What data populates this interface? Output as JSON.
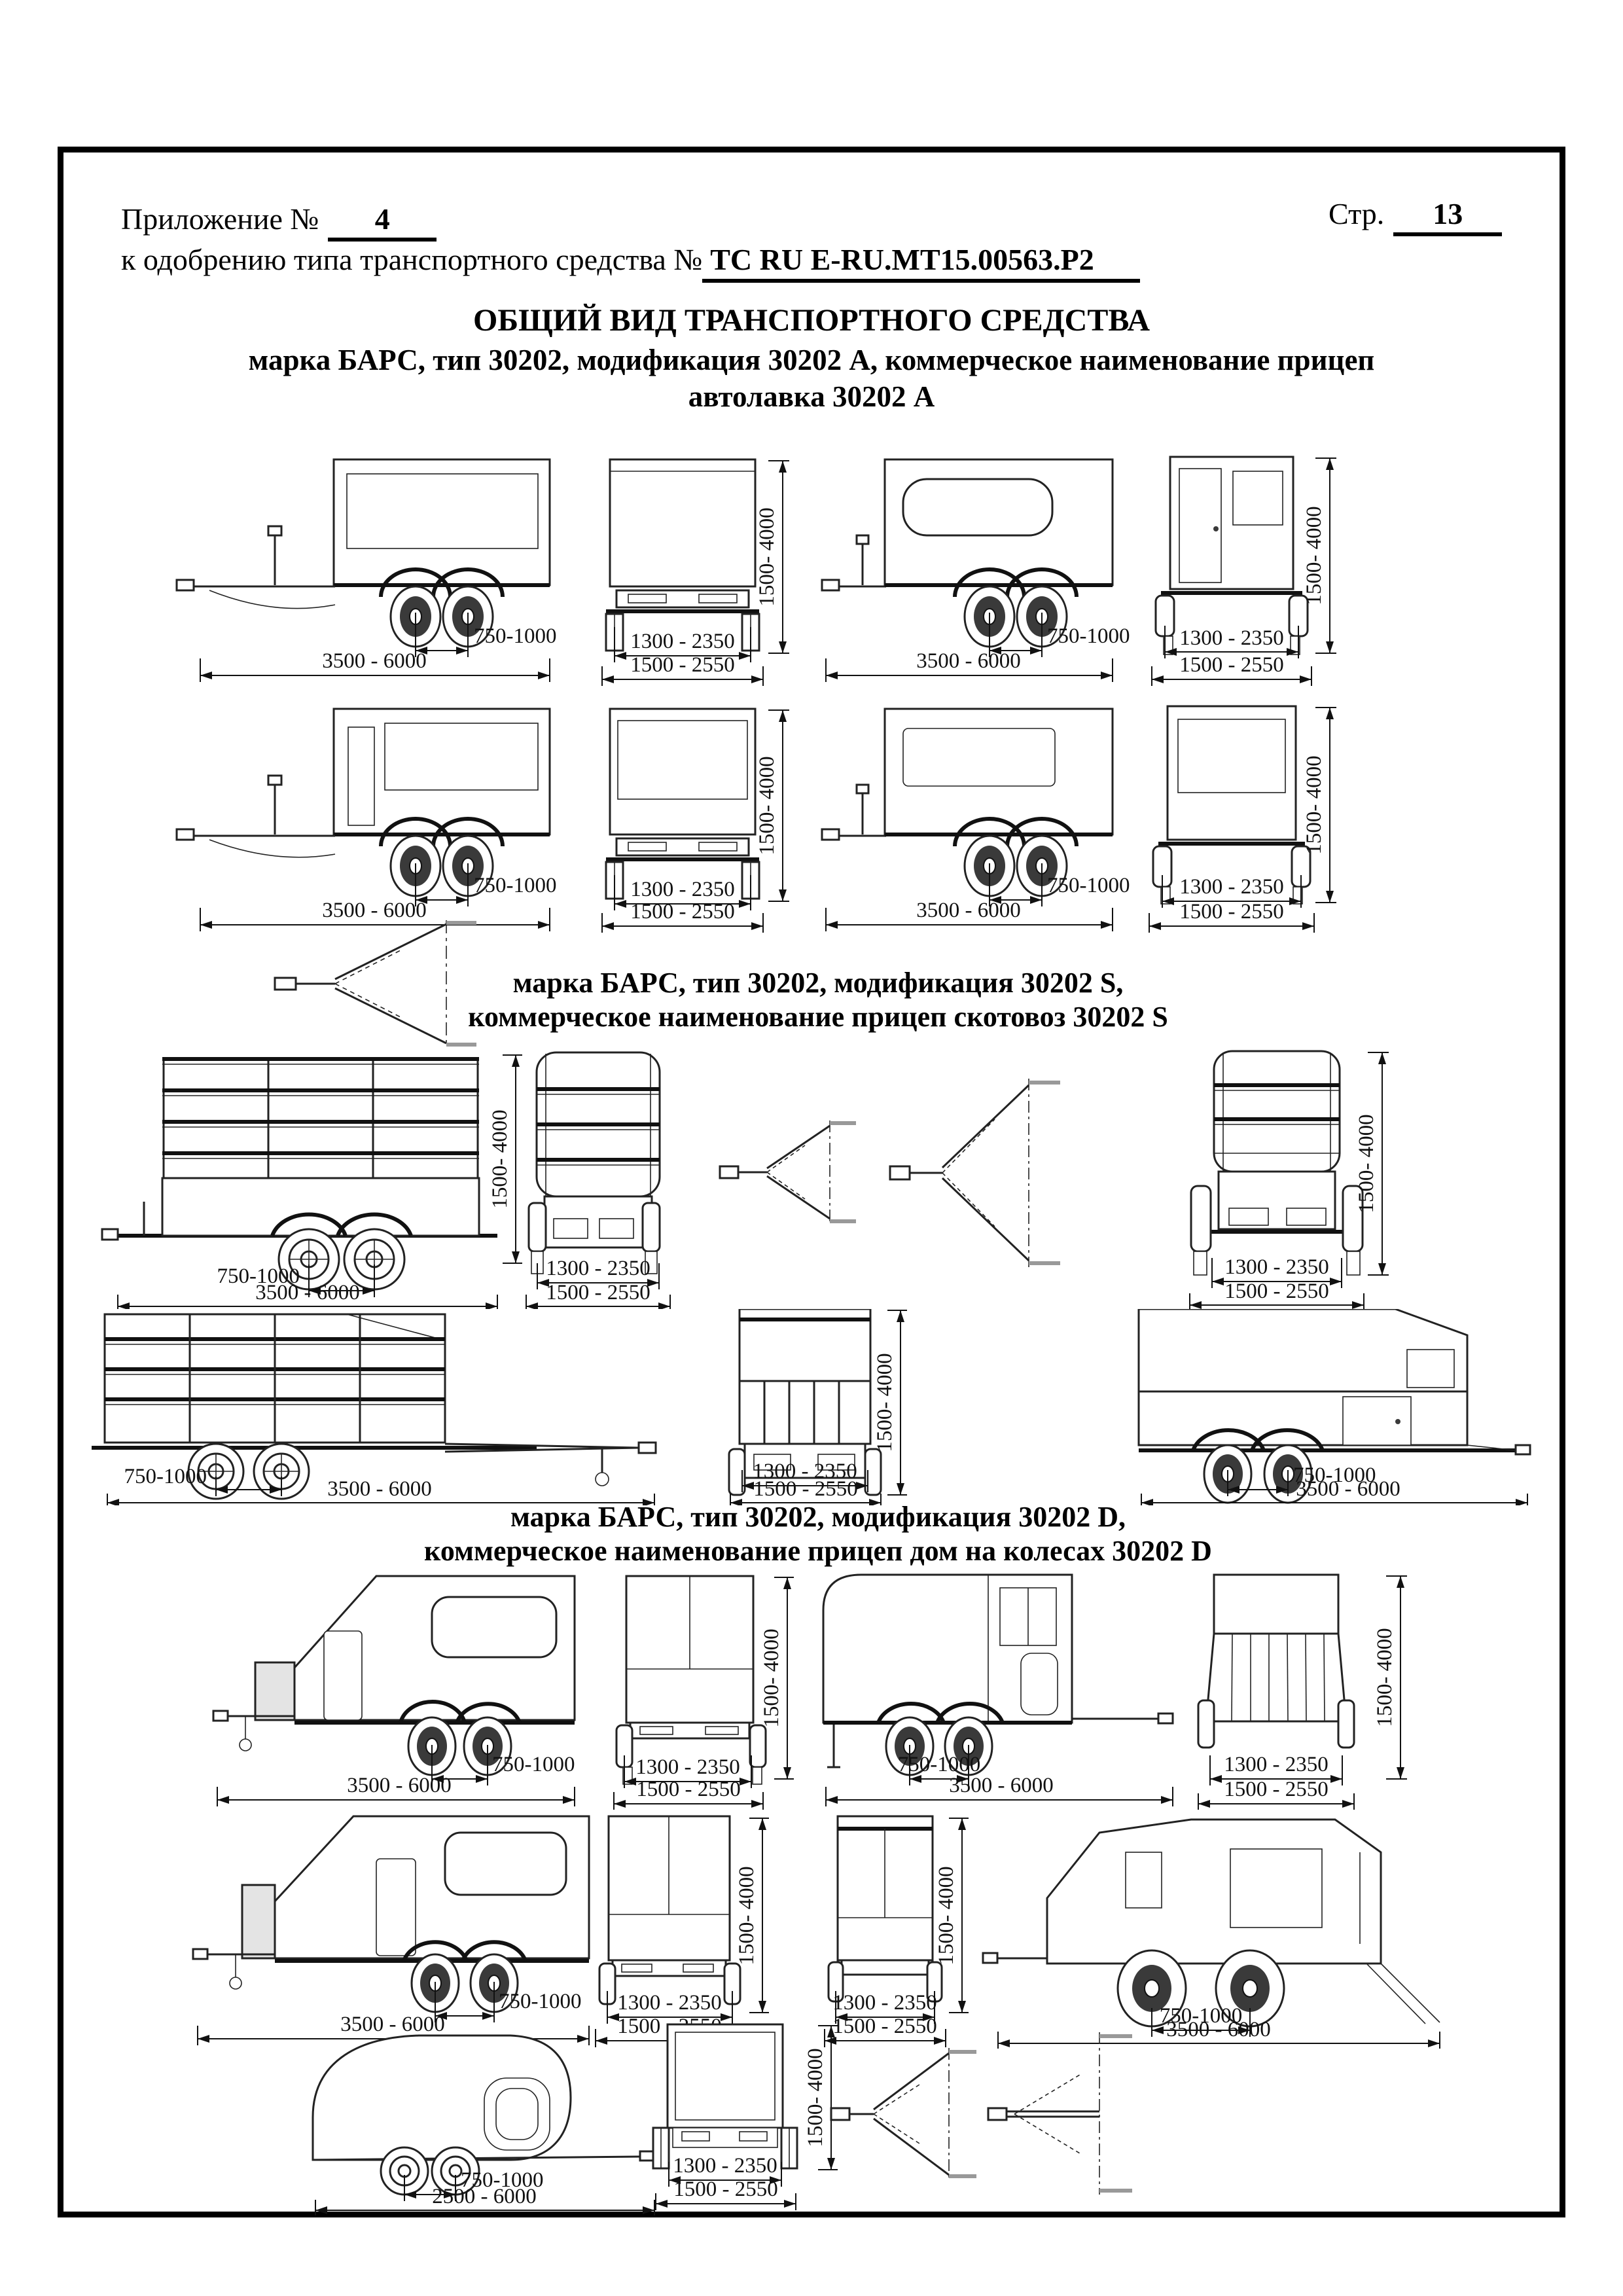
{
  "page": {
    "appendix_label": "Приложение №",
    "appendix_number": "4",
    "page_label": "Стр.",
    "page_number": "13",
    "approval_label": "к одобрению типа транспортного средства №",
    "approval_number": "ТС RU E-RU.MT15.00563.P2"
  },
  "titles": {
    "main": "ОБЩИЙ ВИД ТРАНСПОРТНОГО СРЕДСТВА",
    "sub1": "марка БАРС, тип 30202, модификация 30202 А, коммерческое наименование прицеп",
    "sub2": "автолавка 30202 А"
  },
  "section_s": {
    "line1": "марка БАРС, тип 30202, модификация 30202 S,",
    "line2": "коммерческое наименование прицеп скотовоз 30202 S"
  },
  "section_d": {
    "line1": "марка БАРС, тип 30202, модификация 30202 D,",
    "line2": "коммерческое наименование прицеп дом на колесах 30202 D"
  },
  "dims": {
    "axle_spacing": "750-1000",
    "length": "3500 - 6000",
    "length_teardrop": "2500 - 6000",
    "track": "1300 - 2350",
    "width": "1500 - 2550",
    "height": "1500- 4000"
  }
}
